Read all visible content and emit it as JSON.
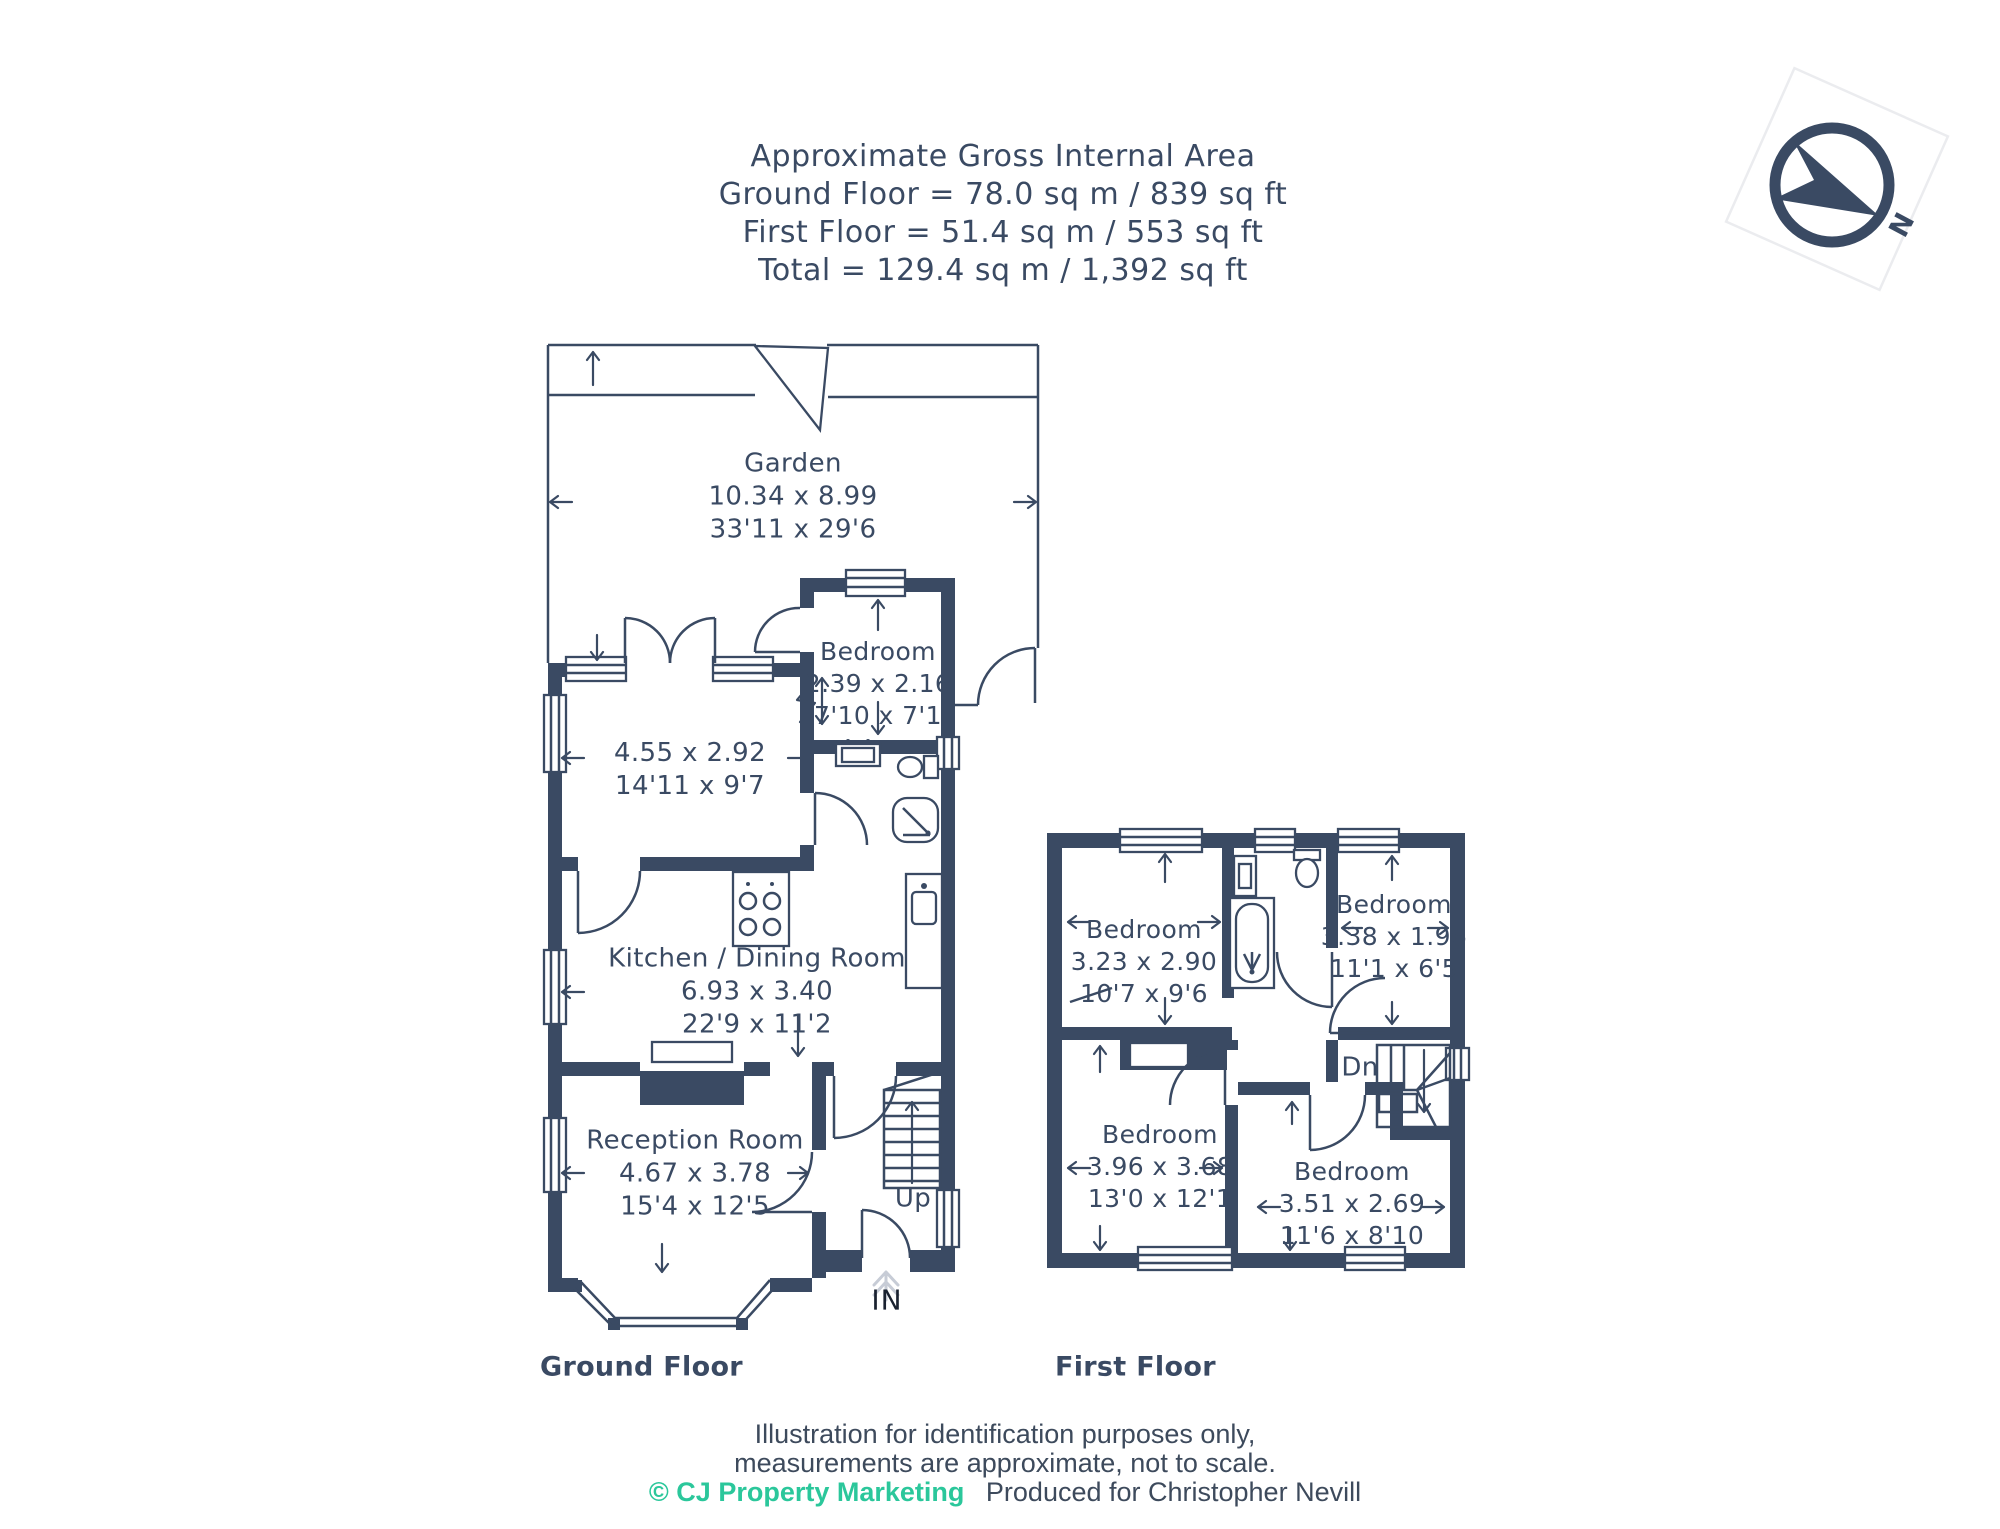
{
  "header": {
    "line1": "Approximate Gross Internal Area",
    "line2": "Ground Floor = 78.0 sq m / 839 sq ft",
    "line3": "First Floor = 51.4 sq m / 553 sq ft",
    "line4": "Total = 129.4 sq m / 1,392 sq ft"
  },
  "compass": {
    "north_label": "N"
  },
  "ground_floor": {
    "title": "Ground Floor",
    "rooms": [
      {
        "name": "Garden",
        "metric": "10.34 x 8.99",
        "imperial": "33'11 x 29'6"
      },
      {
        "name": "Bedroom",
        "metric": "2.39 x 2.16",
        "imperial": "7'10 x 7'1"
      },
      {
        "name": "",
        "metric": "4.55 x 2.92",
        "imperial": "14'11 x 9'7"
      },
      {
        "name": "Kitchen / Dining Room",
        "metric": "6.93 x 3.40",
        "imperial": "22'9 x 11'2"
      },
      {
        "name": "Reception Room",
        "metric": "4.67 x 3.78",
        "imperial": "15'4 x 12'5"
      }
    ],
    "stairs_label": "Up",
    "entry_label": "IN"
  },
  "first_floor": {
    "title": "First Floor",
    "rooms": [
      {
        "name": "Bedroom",
        "metric": "3.23 x 2.90",
        "imperial": "10'7 x 9'6"
      },
      {
        "name": "Bedroom",
        "metric": "3.38 x 1.96",
        "imperial": "11'1 x 6'5"
      },
      {
        "name": "Bedroom",
        "metric": "3.96 x 3.68",
        "imperial": "13'0 x 12'1"
      },
      {
        "name": "Bedroom",
        "metric": "3.51 x 2.69",
        "imperial": "11'6 x 8'10"
      }
    ],
    "stairs_label": "Dn"
  },
  "footer": {
    "line1": "Illustration for identification purposes only,",
    "line2": "measurements are approximate, not to scale.",
    "copyright": "© CJ Property Marketing",
    "produced": "Produced for Christopher Nevill"
  },
  "colors": {
    "wall": "#3a4a63",
    "text": "#3a4a63",
    "accent_teal": "#2bc79b",
    "entry_arrow_gray": "#c7ccd6"
  }
}
